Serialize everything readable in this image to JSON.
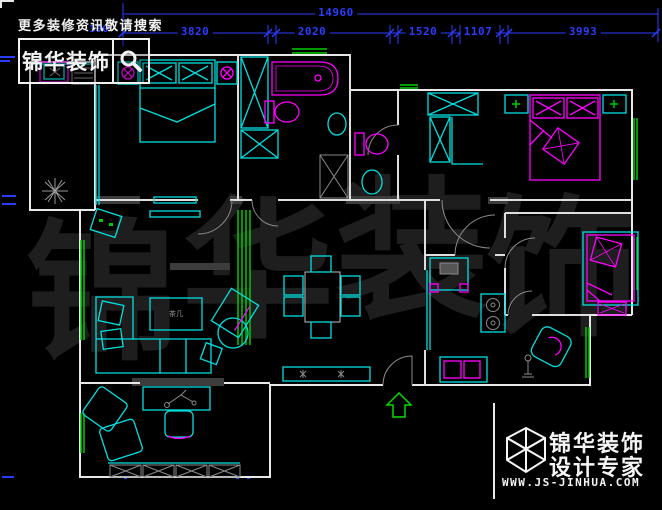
{
  "header": {
    "tagline": "更多装修资讯敬请搜索",
    "search_box": {
      "brand": "锦华装饰",
      "icon": "magnifier-icon"
    }
  },
  "dimensions": {
    "total": "14960",
    "segments": [
      "3820",
      "2020",
      "1520",
      "1107",
      "3993"
    ],
    "left_partial": "300"
  },
  "watermark": {
    "chars": [
      "锦",
      "华",
      "装",
      "饰"
    ]
  },
  "plan": {
    "coffee_table_label": "茶几",
    "colors": {
      "background": "#000000",
      "wall": "#e8e8e8",
      "furniture_cyan": "#00e0e0",
      "fixture_magenta": "#ff00ff",
      "window_green": "#00cc00",
      "dimension_blue": "#2b3cff",
      "detail_gray": "#8a8a8a"
    }
  },
  "footer": {
    "logo_icon": "cube-logo-icon",
    "brand_line1": "锦华装饰",
    "brand_line2": "设计专家",
    "website": "WWW.JS-JINHUA.COM"
  }
}
